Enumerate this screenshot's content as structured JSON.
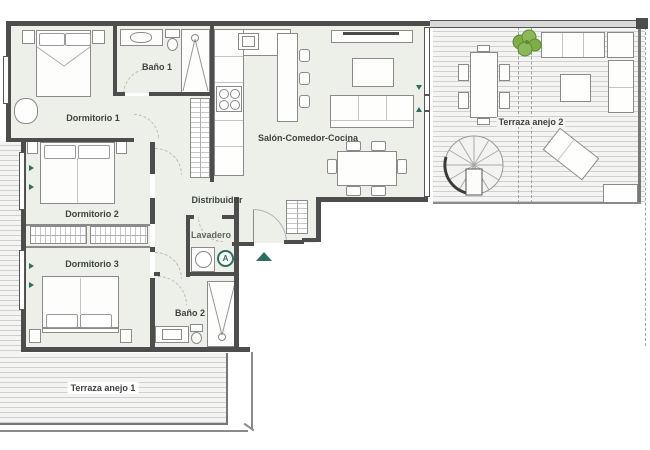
{
  "plan": {
    "rooms": {
      "dormitorio1": {
        "label": "Dormitorio 1"
      },
      "bano1": {
        "label": "Baño 1"
      },
      "dormitorio2": {
        "label": "Dormitorio 2"
      },
      "dormitorio3": {
        "label": "Dormitorio 3"
      },
      "bano2": {
        "label": "Baño 2"
      },
      "salon": {
        "label": "Salón-Comedor-Cocina"
      },
      "distribuidor": {
        "label": "Distribuidor"
      },
      "lavadero": {
        "label": "Lavadero"
      },
      "terraza1": {
        "label": "Terraza anejo 1"
      },
      "terraza2": {
        "label": "Terraza anejo 2"
      }
    },
    "markers": {
      "appliance": {
        "label": "A"
      }
    },
    "colors": {
      "accent_teal": "#2e6e62",
      "wall": "#4d4d4d",
      "room_fill": "#edefe9",
      "furniture_line": "#8a8a8a",
      "plant_green": "#7fae49",
      "deck_stripe": "#cfcfcd"
    }
  }
}
